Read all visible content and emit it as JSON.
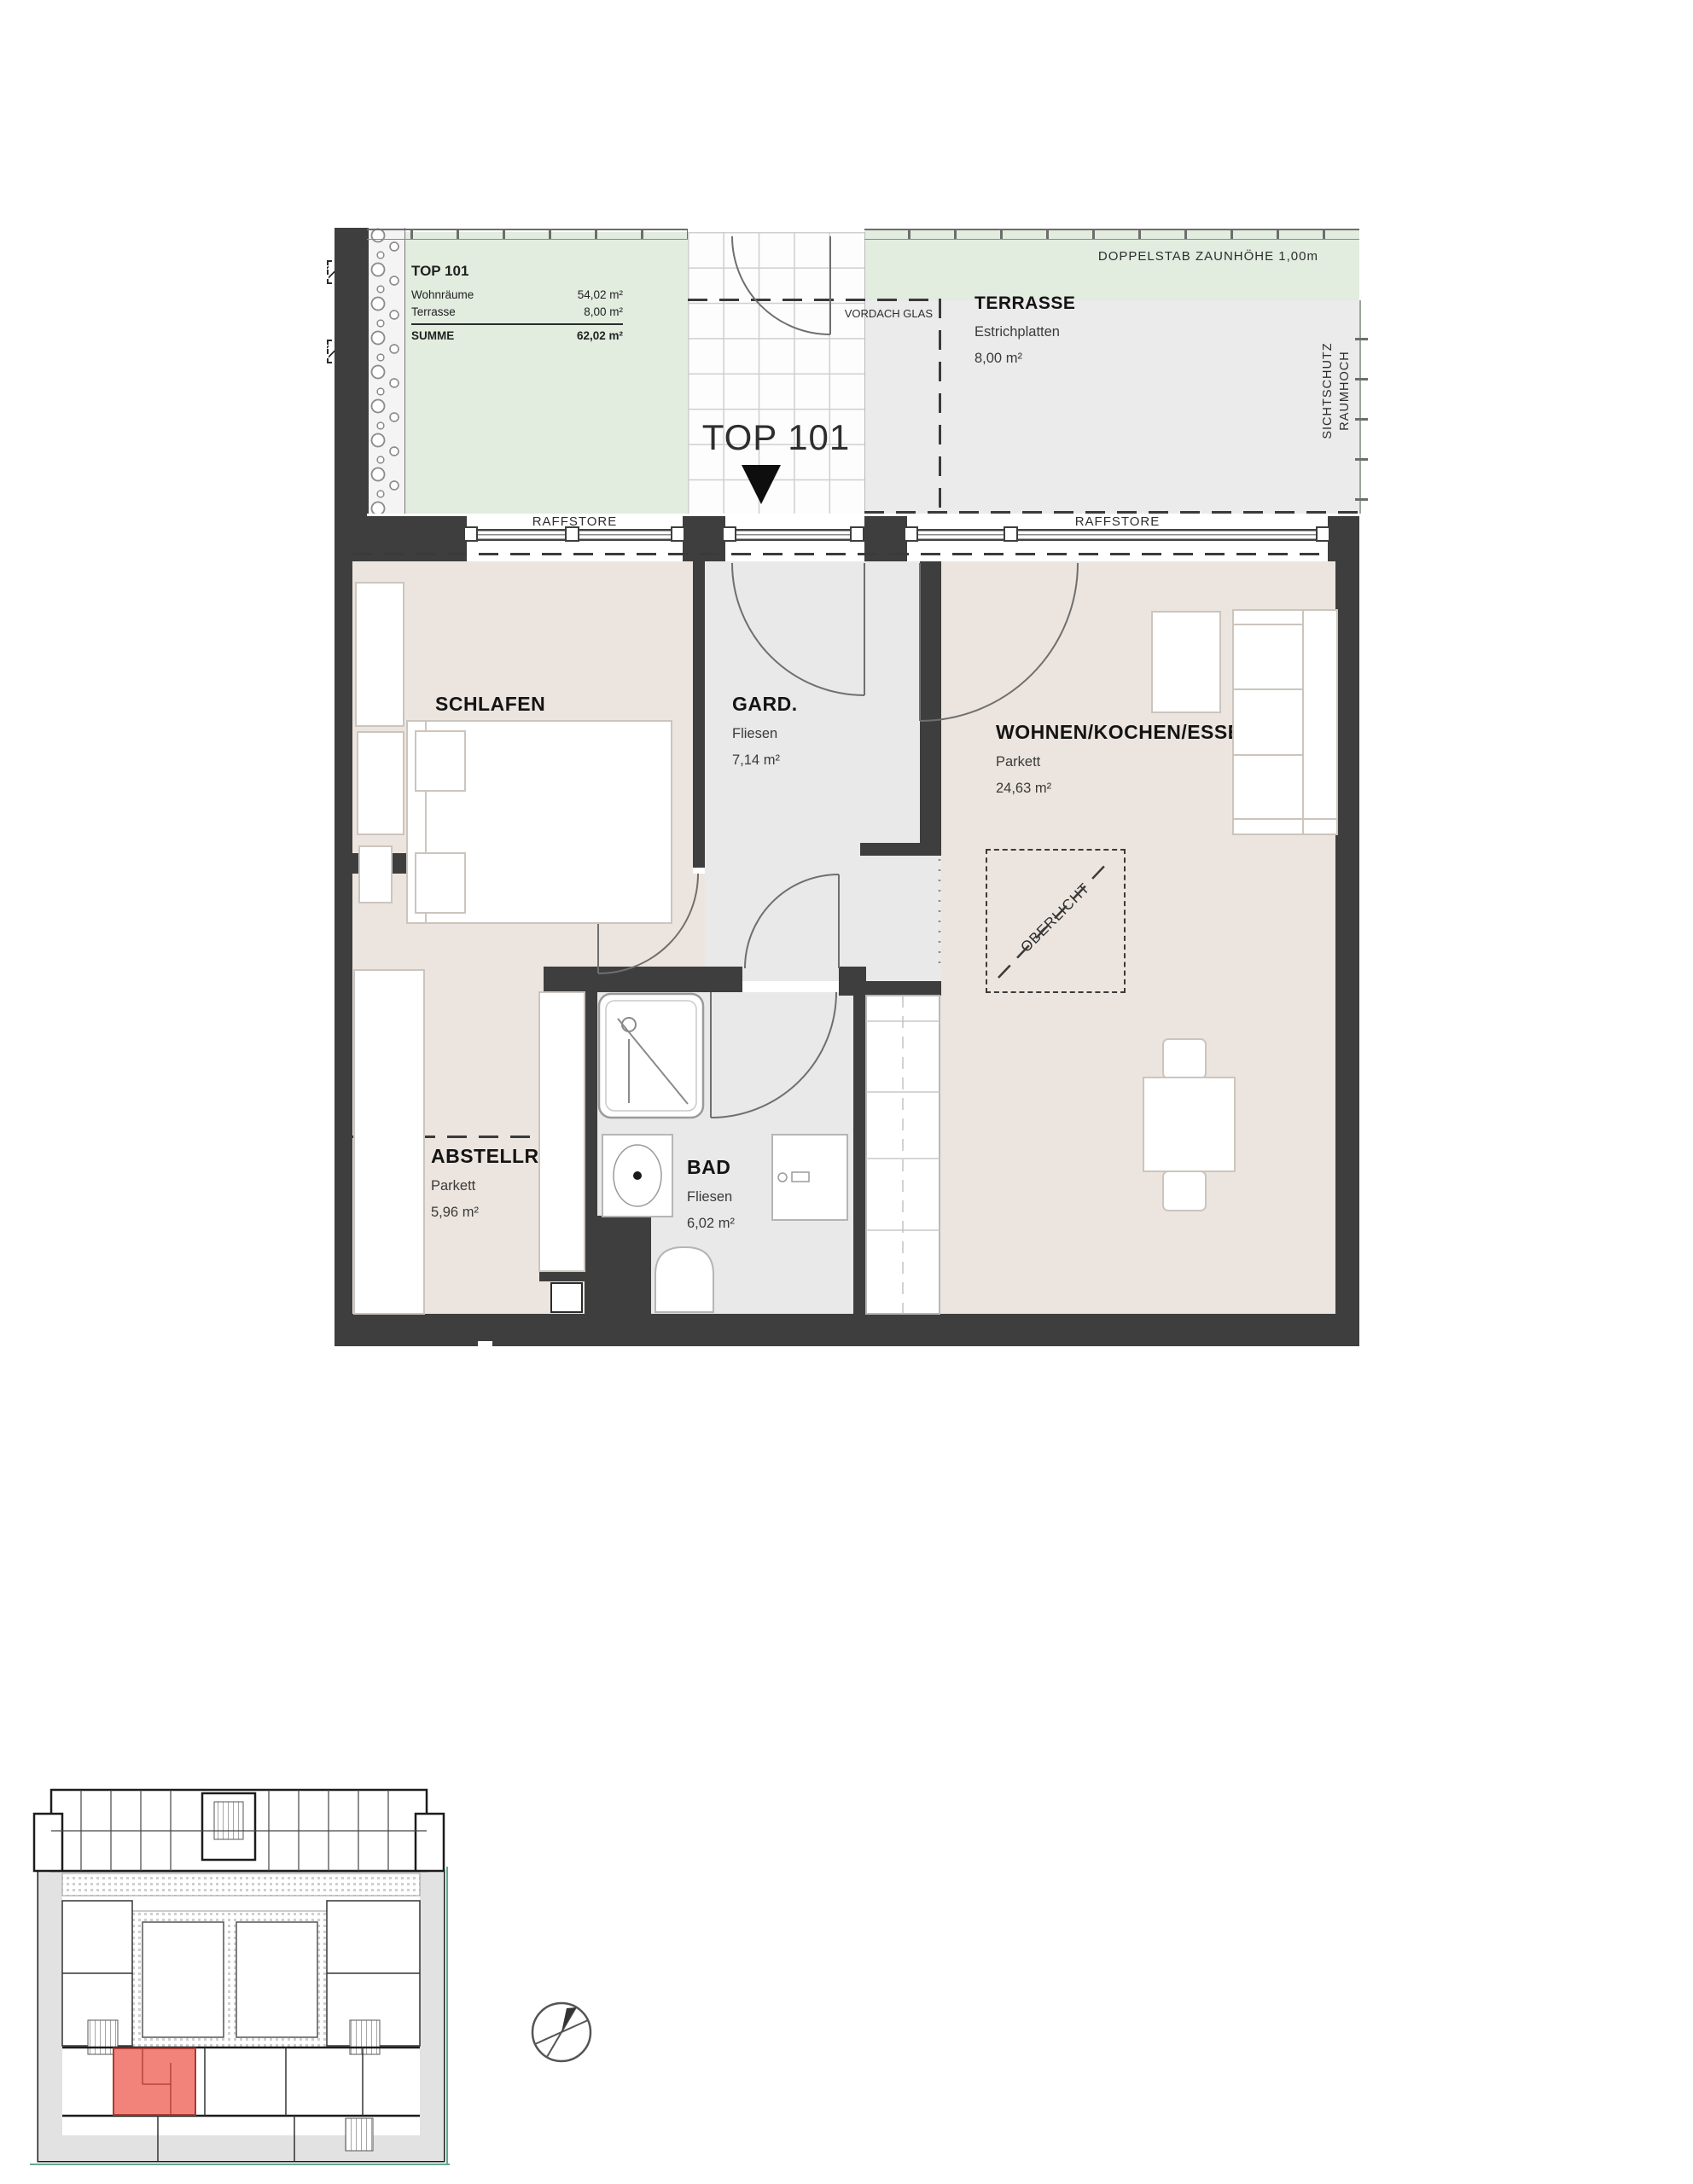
{
  "legend": {
    "title": "TOP 101",
    "rows": [
      {
        "label": "Wohnräume",
        "value": "54,02 m²"
      },
      {
        "label": "Terrasse",
        "value": "8,00 m²"
      }
    ],
    "sum": {
      "label": "SUMME",
      "value": "62,02 m²"
    }
  },
  "unit": {
    "big_label": "TOP 101"
  },
  "outdoor": {
    "fence_note": "DOPPELSTAB ZAUNHÖHE 1,00m",
    "canopy_label": "VORDACH GLAS",
    "privacy": [
      "SICHTSCHUTZ",
      "RAUMHOCH"
    ],
    "blinds_label": "RAFFSTORE",
    "terrace": {
      "name": "TERRASSE",
      "finish": "Estrichplatten",
      "area": "8,00 m²"
    }
  },
  "rooms": {
    "schlafen": {
      "name": "SCHLAFEN",
      "finish": "Parkett",
      "area": "10,27 m²"
    },
    "gard": {
      "name": "GARD.",
      "finish": "Fliesen",
      "area": "7,14 m²"
    },
    "wohnen": {
      "name": "WOHNEN/KOCHEN/ESSEN",
      "finish": "Parkett",
      "area": "24,63 m²"
    },
    "abstell": {
      "name": "ABSTELLRAUM",
      "finish": "Parkett",
      "area": "5,96 m²"
    },
    "bad": {
      "name": "BAD",
      "finish": "Fliesen",
      "area": "6,02 m²"
    }
  },
  "skylight_label": "OBERLICHT",
  "colors": {
    "wall": "#3e3e3e",
    "floor_living": "#ece5df",
    "floor_tiled": "#e9e9e9",
    "garden_green": "#e2ecdf",
    "highlight_unit_red": "#f2837b"
  }
}
